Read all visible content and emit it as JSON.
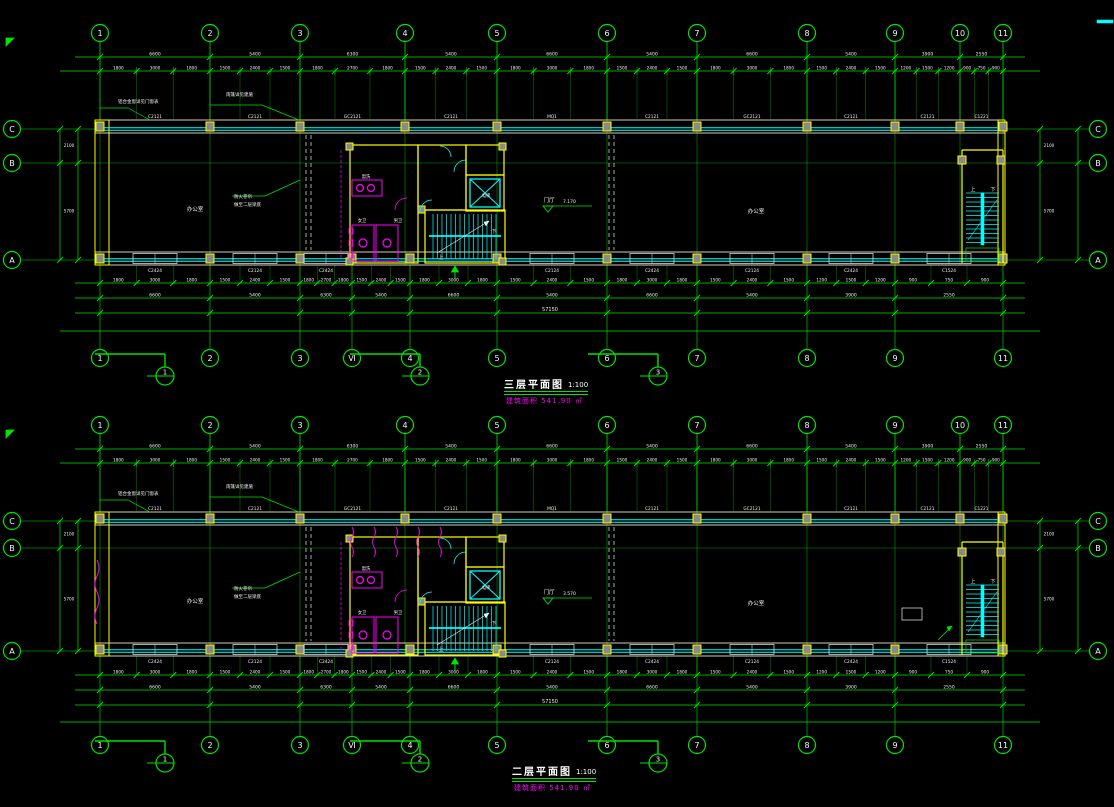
{
  "palette": {
    "background": "#000000",
    "grid_green": "#00e400",
    "glass_cyan": "#00ffff",
    "wall_yellow": "#ffff00",
    "wall_dim_yellow": "#b09000",
    "annotation_magenta": "#ff00ff",
    "text_white": "#f0f0f0",
    "bubble_text": "#e8ffe8",
    "column_fill": "#8a8a8a"
  },
  "grid": {
    "labels_top": [
      "1",
      "2",
      "3",
      "4",
      "5",
      "6",
      "7",
      "8",
      "9",
      "10",
      "11"
    ],
    "labels_bottom": [
      "1",
      "2",
      "3",
      "Ⅵ",
      "4",
      "5",
      "6",
      "7",
      "8",
      "9",
      "11"
    ],
    "row_labels": [
      "C",
      "B",
      "A"
    ],
    "x_top": [
      100,
      210,
      300,
      405,
      497,
      607,
      697,
      807,
      895,
      960,
      1003
    ],
    "x_bottom": [
      100,
      210,
      300,
      352,
      410,
      497,
      607,
      697,
      807,
      895,
      1003
    ],
    "building_x": [
      95,
      1005
    ]
  },
  "dimensions": {
    "major": [
      "6600",
      "5400",
      "6300",
      "5400",
      "6600",
      "5400",
      "6600",
      "5400",
      "3900",
      "2550"
    ],
    "minor": [
      "1800",
      "3000",
      "1800",
      "1500",
      "2400",
      "1500",
      "1800",
      "2700",
      "1800",
      "1500",
      "2400",
      "1500",
      "1800",
      "3000",
      "1800",
      "1500",
      "2400",
      "1500",
      "1800",
      "3000",
      "1800",
      "1500",
      "2400",
      "1500",
      "1200",
      "1500",
      "1200",
      "900",
      "750",
      "900"
    ],
    "overall": "57150",
    "side_major": [
      "2100",
      "5700"
    ],
    "side_overall": "7800"
  },
  "plans": [
    {
      "id": "plan-3f",
      "title": "三层平面图",
      "scale": "1:100",
      "area_note": "建筑面积 541.90 ㎡",
      "y": {
        "bubbleTop": 33,
        "dim1": 57,
        "dim2": 71,
        "wallTop": 120,
        "glassTop": 129,
        "axisB": 163,
        "wallBotTop": 252,
        "glassBot": 260,
        "wallBot": 265,
        "dimB1": 283,
        "dimB2": 298,
        "dimB3": 313,
        "dimB4": 331,
        "bubbleBot": 358,
        "section": 376
      },
      "top_window_codes": [
        "C2121",
        "C2121",
        "GC2121",
        "C2121",
        "MQ1",
        "C2121",
        "GC2121",
        "C2121",
        "C2121",
        "C1221"
      ],
      "bottom_window_codes": [
        "C2424",
        "C2124",
        "C2424",
        "C2124",
        "C2424",
        "C2124",
        "C2424",
        "C1524"
      ],
      "sections": [
        {
          "n": "1",
          "x": 165
        },
        {
          "n": "2",
          "x": 420
        },
        {
          "n": "3",
          "x": 658
        }
      ],
      "notes": [
        {
          "t": "铝合金窗详见门窗表",
          "x": 118,
          "y": 103,
          "c": "#f0f0f0",
          "s": 4.5,
          "a": "start"
        },
        {
          "t": "雨篷详见建施",
          "x": 226,
          "y": 96,
          "c": "#f0f0f0",
          "s": 4.5,
          "a": "start"
        },
        {
          "t": "防火卷帘",
          "x": 234,
          "y": 198,
          "c": "#f0f0f0",
          "s": 4.5,
          "a": "start"
        },
        {
          "t": "做至二层梁底",
          "x": 234,
          "y": 206,
          "c": "#f0f0f0",
          "s": 4.5,
          "a": "start"
        },
        {
          "t": "办公室",
          "x": 195,
          "y": 211,
          "c": "#f0f0f0",
          "s": 5.5,
          "a": "middle"
        },
        {
          "t": "门厅",
          "x": 549,
          "y": 202,
          "c": "#f0f0f0",
          "s": 5.5,
          "a": "middle"
        },
        {
          "t": "办公室",
          "x": 756,
          "y": 213,
          "c": "#f0f0f0",
          "s": 5.5,
          "a": "middle"
        },
        {
          "t": "7.170",
          "x": 563,
          "y": 203,
          "c": "#f0f0f0",
          "s": 4.5,
          "a": "start"
        },
        {
          "t": "盥洗",
          "x": 366,
          "y": 178,
          "c": "#f0f0f0",
          "s": 4.3,
          "a": "middle"
        },
        {
          "t": "女卫",
          "x": 362,
          "y": 222,
          "c": "#f0f0f0",
          "s": 4.3,
          "a": "middle"
        },
        {
          "t": "男卫",
          "x": 398,
          "y": 222,
          "c": "#f0f0f0",
          "s": 4.3,
          "a": "middle"
        },
        {
          "t": "电梯",
          "x": 486,
          "y": 197,
          "c": "#f0f0f0",
          "s": 4.3,
          "a": "middle"
        },
        {
          "t": "上",
          "x": 441,
          "y": 259,
          "c": "#f0f0f0",
          "s": 5,
          "a": "middle"
        },
        {
          "t": "下",
          "x": 494,
          "y": 233,
          "c": "#f0f0f0",
          "s": 5,
          "a": "middle"
        },
        {
          "t": "上",
          "x": 973,
          "y": 191,
          "c": "#f0f0f0",
          "s": 5,
          "a": "middle"
        },
        {
          "t": "下",
          "x": 993,
          "y": 191,
          "c": "#f0f0f0",
          "s": 5,
          "a": "middle"
        }
      ],
      "extras": false
    },
    {
      "id": "plan-2f",
      "title": "二层平面图",
      "scale": "1:100",
      "area_note": "建筑面积 541.90 ㎡",
      "y": {
        "bubbleTop": 425,
        "dim1": 449,
        "dim2": 463,
        "wallTop": 512,
        "glassTop": 521,
        "axisB": 548,
        "wallBotTop": 643,
        "glassBot": 651,
        "wallBot": 656,
        "dimB1": 675,
        "dimB2": 690,
        "dimB3": 705,
        "dimB4": 722,
        "bubbleBot": 745,
        "section": 763
      },
      "top_window_codes": [
        "C2121",
        "C2121",
        "GC2121",
        "C2121",
        "MQ1",
        "C2121",
        "GC2121",
        "C2121",
        "C2121",
        "C1221"
      ],
      "bottom_window_codes": [
        "C2424",
        "C2124",
        "C2424",
        "C2124",
        "C2424",
        "C2124",
        "C2424",
        "C1524"
      ],
      "sections": [
        {
          "n": "1",
          "x": 165
        },
        {
          "n": "2",
          "x": 420
        },
        {
          "n": "3",
          "x": 658
        }
      ],
      "notes": [
        {
          "t": "铝合金窗详见门窗表",
          "x": 118,
          "y": 495,
          "c": "#f0f0f0",
          "s": 4.5,
          "a": "start"
        },
        {
          "t": "雨篷详见建施",
          "x": 226,
          "y": 488,
          "c": "#f0f0f0",
          "s": 4.5,
          "a": "start"
        },
        {
          "t": "防火卷帘",
          "x": 234,
          "y": 590,
          "c": "#f0f0f0",
          "s": 4.5,
          "a": "start"
        },
        {
          "t": "做至二层梁底",
          "x": 234,
          "y": 598,
          "c": "#f0f0f0",
          "s": 4.5,
          "a": "start"
        },
        {
          "t": "办公室",
          "x": 195,
          "y": 603,
          "c": "#f0f0f0",
          "s": 5.5,
          "a": "middle"
        },
        {
          "t": "门厅",
          "x": 549,
          "y": 594,
          "c": "#f0f0f0",
          "s": 5.5,
          "a": "middle"
        },
        {
          "t": "办公室",
          "x": 756,
          "y": 605,
          "c": "#f0f0f0",
          "s": 5.5,
          "a": "middle"
        },
        {
          "t": "3.570",
          "x": 563,
          "y": 595,
          "c": "#f0f0f0",
          "s": 4.5,
          "a": "start"
        },
        {
          "t": "盥洗",
          "x": 366,
          "y": 570,
          "c": "#f0f0f0",
          "s": 4.3,
          "a": "middle"
        },
        {
          "t": "女卫",
          "x": 362,
          "y": 614,
          "c": "#f0f0f0",
          "s": 4.3,
          "a": "middle"
        },
        {
          "t": "男卫",
          "x": 398,
          "y": 614,
          "c": "#f0f0f0",
          "s": 4.3,
          "a": "middle"
        },
        {
          "t": "电梯",
          "x": 486,
          "y": 589,
          "c": "#f0f0f0",
          "s": 4.3,
          "a": "middle"
        },
        {
          "t": "上",
          "x": 441,
          "y": 651,
          "c": "#f0f0f0",
          "s": 5,
          "a": "middle"
        },
        {
          "t": "下",
          "x": 494,
          "y": 625,
          "c": "#f0f0f0",
          "s": 5,
          "a": "middle"
        },
        {
          "t": "上",
          "x": 973,
          "y": 583,
          "c": "#f0f0f0",
          "s": 5,
          "a": "middle"
        },
        {
          "t": "下",
          "x": 993,
          "y": 583,
          "c": "#f0f0f0",
          "s": 5,
          "a": "middle"
        }
      ],
      "extras": true
    }
  ],
  "misc": {
    "corner_marks": [
      {
        "x": 6,
        "y": 38
      },
      {
        "x": 6,
        "y": 430
      }
    ],
    "edge_mark": {
      "x": 1097,
      "y": 20
    }
  }
}
